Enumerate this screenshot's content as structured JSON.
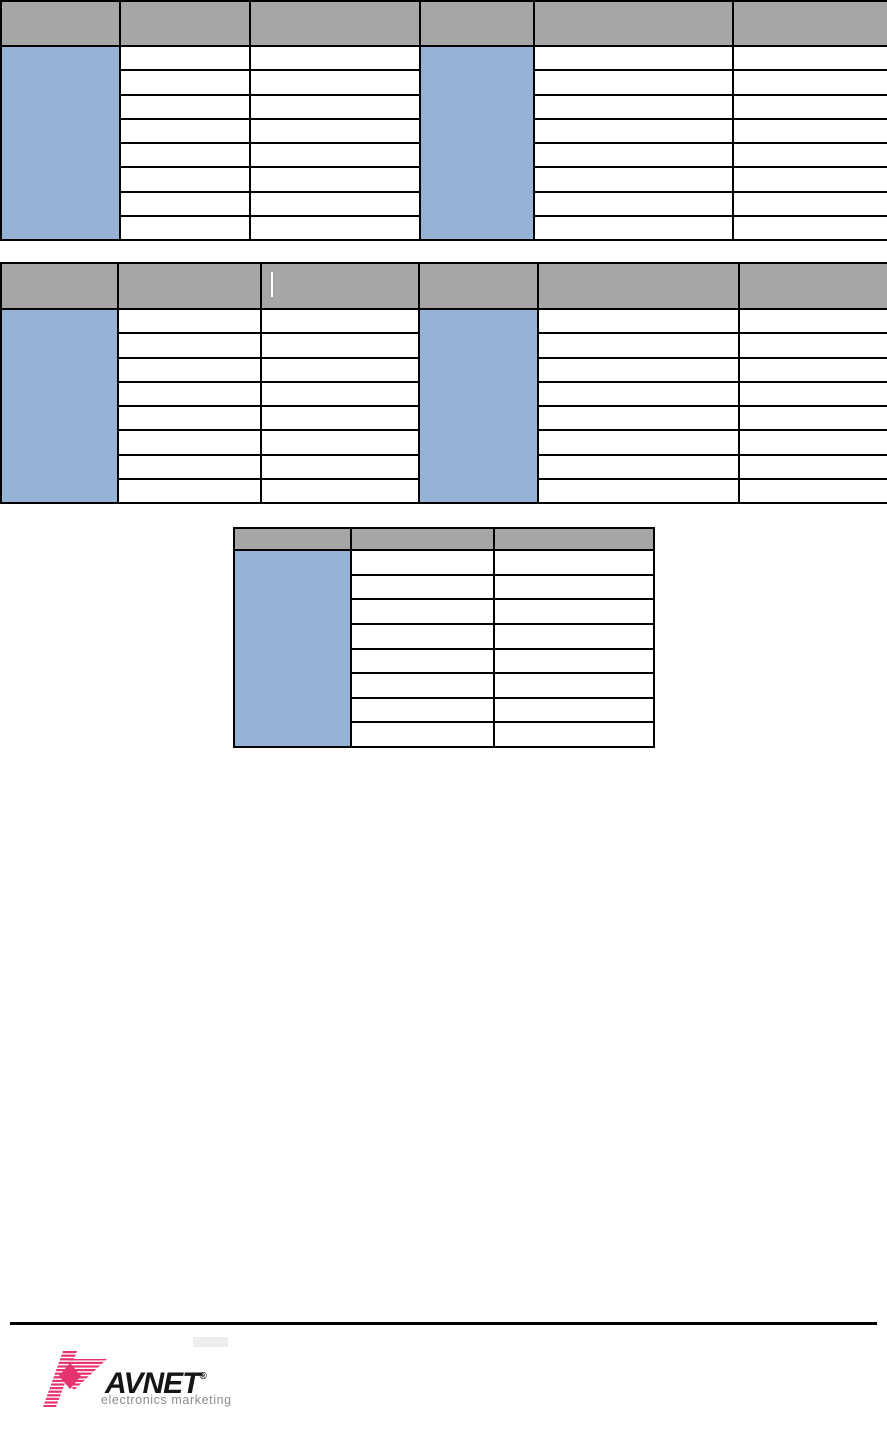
{
  "page": {
    "width": 887,
    "height": 1444,
    "background": "#ffffff"
  },
  "colors": {
    "header_gray": "#a6a6a6",
    "accent_blue": "#95b3d7",
    "border_black": "#000000",
    "rule_black": "#000000",
    "cursor_white": "#ffffff",
    "logo_pink": "#e6336e",
    "logo_text_black": "#161616",
    "logo_tagline_gray": "#8d8d8d"
  },
  "tables": [
    {
      "name": "table-1-left",
      "x": 0,
      "y": 0,
      "width": 419,
      "height": 241,
      "header_height": 45,
      "rows": 8,
      "col_widths": [
        119,
        130,
        170
      ],
      "header_cells": [
        "",
        "",
        ""
      ],
      "cells_empty": true
    },
    {
      "name": "table-1-right",
      "x": 419,
      "y": 0,
      "width": 468,
      "height": 241,
      "header_height": 45,
      "rows": 8,
      "col_widths": [
        114,
        199,
        155
      ],
      "header_cells": [
        "",
        "",
        ""
      ],
      "cells_empty": true
    },
    {
      "name": "table-2-left",
      "x": 0,
      "y": 262,
      "width": 418,
      "height": 242,
      "header_height": 46,
      "rows": 8,
      "col_widths": [
        117,
        143,
        158
      ],
      "header_cells": [
        "",
        "",
        ""
      ],
      "cells_empty": true,
      "cursor": {
        "col": 2,
        "left": 9,
        "top": 8,
        "height": 25
      }
    },
    {
      "name": "table-2-right",
      "x": 418,
      "y": 262,
      "width": 469,
      "height": 242,
      "header_height": 46,
      "rows": 8,
      "col_widths": [
        119,
        201,
        149
      ],
      "header_cells": [
        "",
        "",
        ""
      ],
      "cells_empty": true
    },
    {
      "name": "table-3",
      "x": 233,
      "y": 527,
      "width": 420,
      "height": 221,
      "header_height": 22,
      "rows": 8,
      "col_widths": [
        117,
        143,
        160
      ],
      "header_cells": [
        "",
        "",
        ""
      ],
      "cells_empty": true
    }
  ],
  "footer": {
    "rule": {
      "x": 10,
      "y": 1322,
      "width": 867,
      "height": 3
    },
    "logo": {
      "brand": "AVNET",
      "registered": "®",
      "tagline": "electronics marketing"
    }
  }
}
